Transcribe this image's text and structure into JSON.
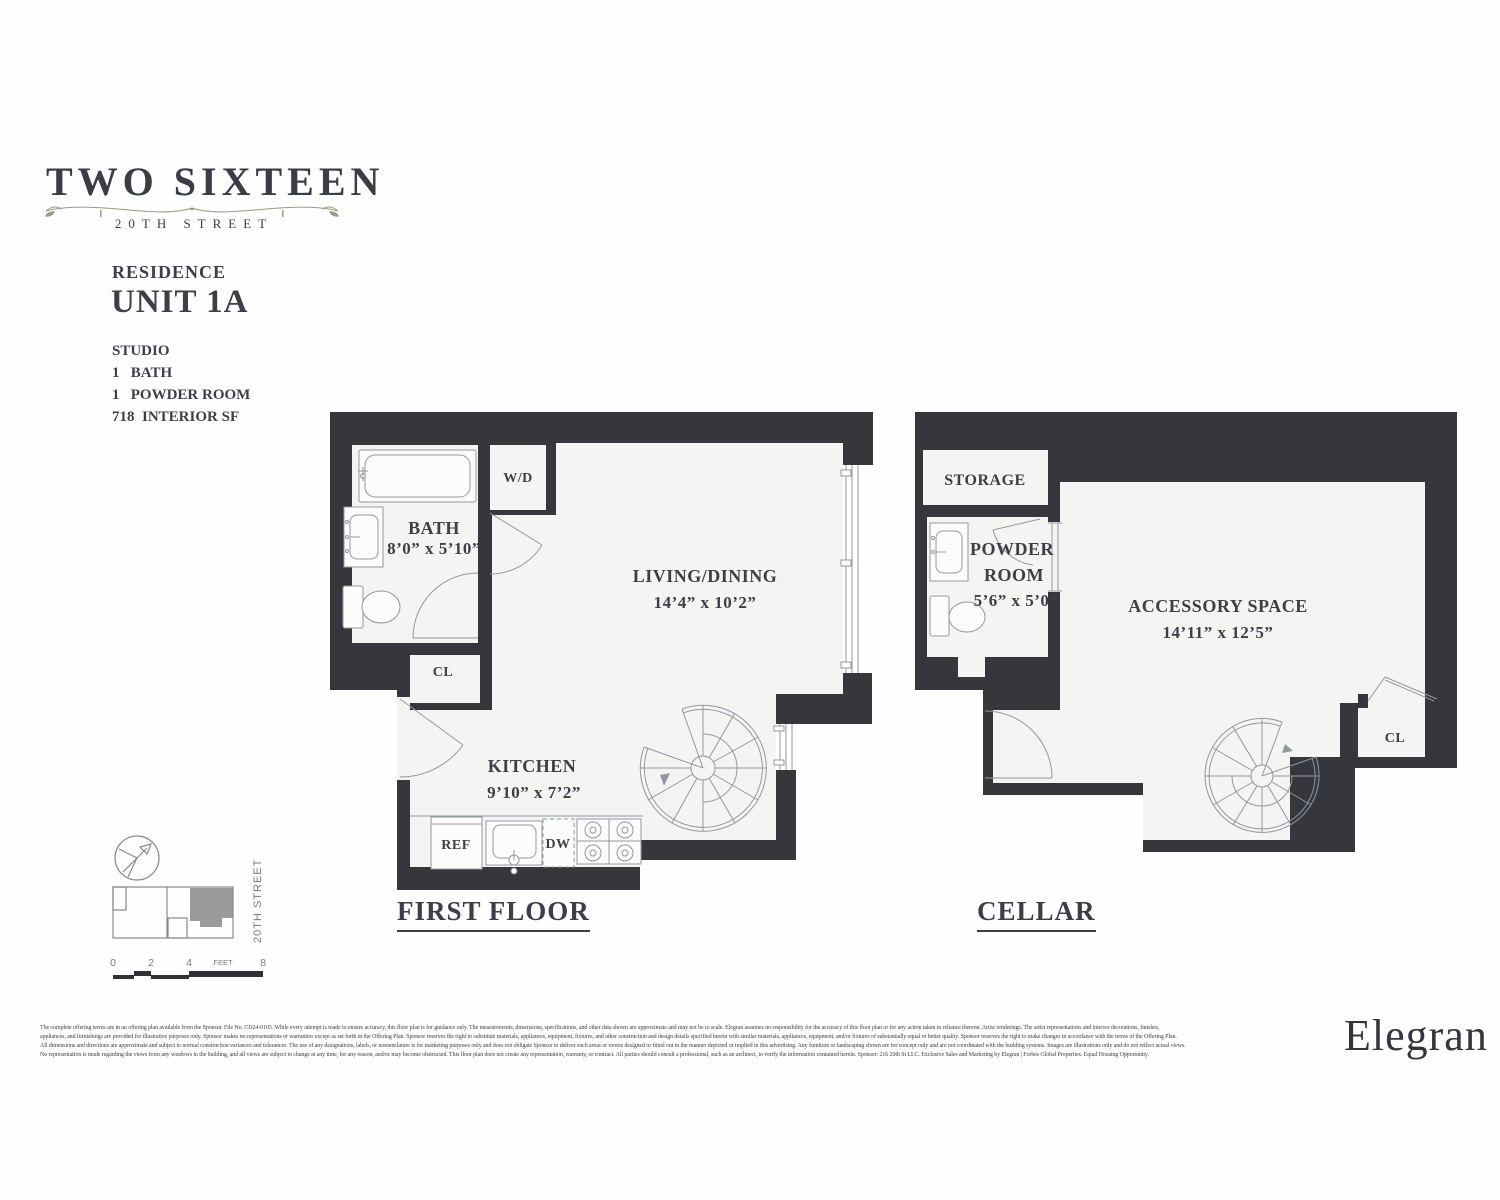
{
  "brand": {
    "title": "TWO SIXTEEN",
    "subtitle": "20TH STREET"
  },
  "residence": {
    "heading": "RESIDENCE",
    "unit": "UNIT 1A",
    "features": [
      "STUDIO",
      "1   BATH",
      "1   POWDER ROOM",
      "718  INTERIOR SF"
    ]
  },
  "first_floor": {
    "heading": "FIRST FLOOR",
    "bath_name": "BATH",
    "bath_dims": "8’0” x 5’10”",
    "wd_label": "W/D",
    "living_name": "LIVING/DINING",
    "living_dims": "14’4” x 10’2”",
    "closet_label": "CL",
    "kitchen_name": "KITCHEN",
    "kitchen_dims": "9’10” x 7’2”",
    "ref_label": "REF",
    "dw_label": "DW"
  },
  "cellar": {
    "heading": "CELLAR",
    "storage_label": "STORAGE",
    "powder_line1": "POWDER",
    "powder_line2": "ROOM",
    "powder_dims": "5’6” x 5’0”",
    "accessory_name": "ACCESSORY SPACE",
    "accessory_dims": "14’11” x 12’5”",
    "closet_label": "CL"
  },
  "key_plan": {
    "street_label": "20TH STREET",
    "scale_ticks": [
      "0",
      "2",
      "4",
      "8"
    ],
    "scale_unit": "FEET"
  },
  "disclaimer": {
    "line1": "The complete offering terms are in an offering plan available from the Sponsor. File No. CD24-0105. While every attempt is made to ensure accuracy, this floor plan is for guidance only. The measurements, dimensions, specifications, and other data shown are approximate and may not be to scale. Elegran assumes no responsibility for the accuracy of this floor plan or for any action taken in reliance thereon. Artist renderings. The artist representations and interior decorations, finishes,",
    "line2": "appliances, and furnishings are provided for illustrative purposes only. Sponsor makes no representations or warranties except as set forth in the Offering Plan. Sponsor reserves the right to substitute materials, appliances, equipment, fixtures, and other construction and design details specified herein with similar materials, appliances, equipment, and/or fixtures of substantially equal or better quality. Sponsor reserves the right to make changes in accordance with the terms of the Offering Plan.",
    "line3": "All dimensions and directions are approximate and subject to normal construction variances and tolerances. The use of any designations, labels, or nomenclature is for marketing purposes only and does not obligate Sponsor to deliver such areas or rooms designed or fitted out in the manner depicted or implied in this advertising. Any furniture or landscaping shown are for concept only and are not coordinated with the building systems. Images are illustrations only and do not reflect actual views.",
    "line4": "No representation is made regarding the views from any windows in the building, and all views are subject to change at any time, for any reason, and/or may become obstructed. This floor plan does not create any representation, warranty, or contract. All parties should consult a professional, such as an architect, to verify the information contained herein. Sponsor: 216 20th St LLC. Exclusive Sales and Marketing by Elegran | Forbes Global Properties. Equal Housing Opportunity.",
    "colors": {
      "wall": "#35373d",
      "floor": "#f4f4f3",
      "text": "#3d3f48",
      "keyplan_unit_fill": "#9b9b9b"
    }
  },
  "logo_text": "Elegran"
}
